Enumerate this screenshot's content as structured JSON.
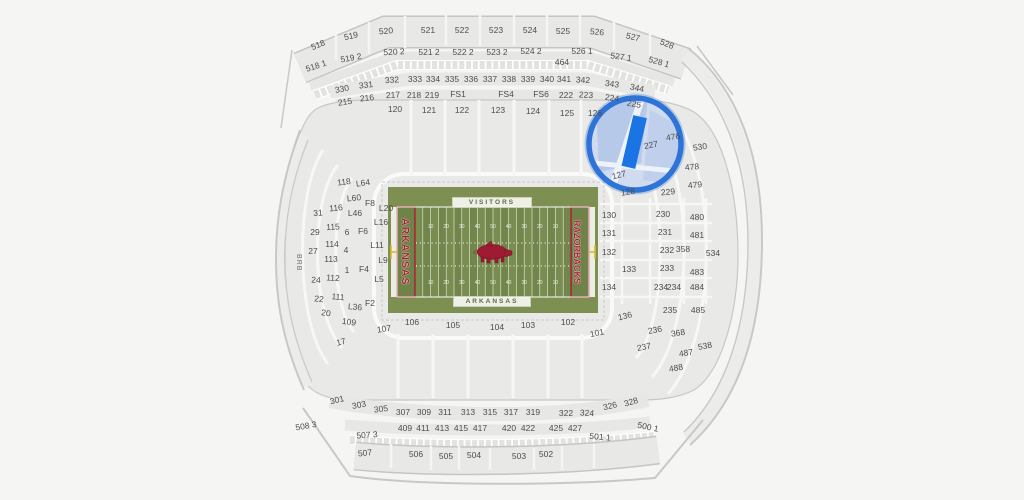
{
  "map": {
    "background": "#f5f5f3",
    "section_fill": "#e8e8e6",
    "section_stroke": "#c6c6c4",
    "label_color": "#4d4d4d",
    "left_wall_label": "BRB",
    "highlight": {
      "section": "227",
      "ring_color": "#2d73d8",
      "area_fill": "#cdd9ef",
      "selected_fill": "#1b74e4",
      "cx": 635,
      "cy": 144,
      "radius": 46
    },
    "field": {
      "visitors_label": "VISITORS",
      "home_label": "ARKANSAS",
      "left_endzone_text": "ARKANSAS",
      "right_endzone_text": "RAZORBACKS",
      "yard_numbers": [
        "10",
        "20",
        "30",
        "40",
        "50",
        "40",
        "30",
        "20",
        "10"
      ],
      "grass_base": "#7d9052",
      "stripe_light": "#7a8d50",
      "stripe_dark": "#72854a",
      "endzone_fill": "#6f8247",
      "endzone_red": "#a81e35",
      "logo_red": "#9e1b32",
      "goalpost_yellow": "#d9b92c"
    },
    "sections": [
      {
        "t": "518",
        "x": 318,
        "y": 45,
        "r": -22
      },
      {
        "t": "519",
        "x": 351,
        "y": 36,
        "r": -13
      },
      {
        "t": "520",
        "x": 386,
        "y": 31,
        "r": -5
      },
      {
        "t": "521",
        "x": 428,
        "y": 30,
        "r": 0
      },
      {
        "t": "522",
        "x": 462,
        "y": 30,
        "r": 0
      },
      {
        "t": "523",
        "x": 496,
        "y": 30,
        "r": 0
      },
      {
        "t": "524",
        "x": 530,
        "y": 30,
        "r": 0
      },
      {
        "t": "525",
        "x": 563,
        "y": 31,
        "r": 0
      },
      {
        "t": "526",
        "x": 597,
        "y": 32,
        "r": 5
      },
      {
        "t": "527",
        "x": 633,
        "y": 37,
        "r": 13
      },
      {
        "t": "528",
        "x": 667,
        "y": 44,
        "r": 22
      },
      {
        "t": "518 1",
        "x": 316,
        "y": 66,
        "r": -18
      },
      {
        "t": "519 2",
        "x": 351,
        "y": 58,
        "r": -10
      },
      {
        "t": "520 2",
        "x": 394,
        "y": 52,
        "r": -3
      },
      {
        "t": "521 2",
        "x": 429,
        "y": 52,
        "r": 0
      },
      {
        "t": "522 2",
        "x": 463,
        "y": 52,
        "r": 0
      },
      {
        "t": "523 2",
        "x": 497,
        "y": 52,
        "r": 0
      },
      {
        "t": "524 2",
        "x": 531,
        "y": 51,
        "r": 0
      },
      {
        "t": "526 1",
        "x": 582,
        "y": 51,
        "r": 0
      },
      {
        "t": "527 1",
        "x": 621,
        "y": 57,
        "r": 8
      },
      {
        "t": "528 1",
        "x": 659,
        "y": 62,
        "r": 16
      },
      {
        "t": "464",
        "x": 562,
        "y": 62,
        "r": 0
      },
      {
        "t": "330",
        "x": 342,
        "y": 89,
        "r": -10
      },
      {
        "t": "331",
        "x": 366,
        "y": 85,
        "r": -7
      },
      {
        "t": "332",
        "x": 392,
        "y": 80,
        "r": -4
      },
      {
        "t": "333",
        "x": 415,
        "y": 79,
        "r": 0
      },
      {
        "t": "334",
        "x": 433,
        "y": 79,
        "r": 0
      },
      {
        "t": "335",
        "x": 452,
        "y": 79,
        "r": 0
      },
      {
        "t": "336",
        "x": 471,
        "y": 79,
        "r": 0
      },
      {
        "t": "337",
        "x": 490,
        "y": 79,
        "r": 0
      },
      {
        "t": "338",
        "x": 509,
        "y": 79,
        "r": 0
      },
      {
        "t": "339",
        "x": 528,
        "y": 79,
        "r": 0
      },
      {
        "t": "340",
        "x": 547,
        "y": 79,
        "r": 0
      },
      {
        "t": "341",
        "x": 564,
        "y": 79,
        "r": 0
      },
      {
        "t": "342",
        "x": 583,
        "y": 80,
        "r": 3
      },
      {
        "t": "343",
        "x": 612,
        "y": 84,
        "r": 8
      },
      {
        "t": "344",
        "x": 637,
        "y": 88,
        "r": 12
      },
      {
        "t": "215",
        "x": 345,
        "y": 102,
        "r": -8
      },
      {
        "t": "216",
        "x": 367,
        "y": 98,
        "r": -6
      },
      {
        "t": "217",
        "x": 393,
        "y": 95,
        "r": -3
      },
      {
        "t": "218",
        "x": 414,
        "y": 95,
        "r": 0
      },
      {
        "t": "219",
        "x": 432,
        "y": 95,
        "r": 0
      },
      {
        "t": "FS1",
        "x": 458,
        "y": 94,
        "r": 0
      },
      {
        "t": "FS4",
        "x": 506,
        "y": 94,
        "r": 0
      },
      {
        "t": "FS6",
        "x": 541,
        "y": 94,
        "r": 0
      },
      {
        "t": "222",
        "x": 566,
        "y": 95,
        "r": 0
      },
      {
        "t": "223",
        "x": 586,
        "y": 95,
        "r": 3
      },
      {
        "t": "224",
        "x": 612,
        "y": 98,
        "r": 8
      },
      {
        "t": "225",
        "x": 634,
        "y": 104,
        "r": 10
      },
      {
        "t": "120",
        "x": 395,
        "y": 109,
        "r": 0
      },
      {
        "t": "121",
        "x": 429,
        "y": 110,
        "r": 0
      },
      {
        "t": "122",
        "x": 462,
        "y": 110,
        "r": 0
      },
      {
        "t": "123",
        "x": 498,
        "y": 110,
        "r": 0
      },
      {
        "t": "124",
        "x": 533,
        "y": 111,
        "r": 0
      },
      {
        "t": "125",
        "x": 567,
        "y": 113,
        "r": 0
      },
      {
        "t": "126",
        "x": 595,
        "y": 113,
        "r": 0
      },
      {
        "t": "118",
        "x": 344,
        "y": 182,
        "r": -8
      },
      {
        "t": "116",
        "x": 336,
        "y": 208,
        "r": -5
      },
      {
        "t": "115",
        "x": 333,
        "y": 227,
        "r": -3
      },
      {
        "t": "114",
        "x": 332,
        "y": 244,
        "r": 0
      },
      {
        "t": "113",
        "x": 331,
        "y": 259,
        "r": 0
      },
      {
        "t": "112",
        "x": 333,
        "y": 278,
        "r": 3
      },
      {
        "t": "111",
        "x": 338,
        "y": 297,
        "r": 5
      },
      {
        "t": "109",
        "x": 349,
        "y": 322,
        "r": 8
      },
      {
        "t": "L64",
        "x": 363,
        "y": 183,
        "r": -8
      },
      {
        "t": "L60",
        "x": 354,
        "y": 198,
        "r": -5
      },
      {
        "t": "F8",
        "x": 370,
        "y": 203,
        "r": 0
      },
      {
        "t": "L20",
        "x": 386,
        "y": 208,
        "r": 0
      },
      {
        "t": "L46",
        "x": 355,
        "y": 213,
        "r": 0
      },
      {
        "t": "L16",
        "x": 381,
        "y": 222,
        "r": 0
      },
      {
        "t": "6",
        "x": 347,
        "y": 232,
        "r": 0
      },
      {
        "t": "F6",
        "x": 363,
        "y": 231,
        "r": 0
      },
      {
        "t": "L11",
        "x": 377,
        "y": 245,
        "r": 0
      },
      {
        "t": "4",
        "x": 346,
        "y": 250,
        "r": 0
      },
      {
        "t": "L9",
        "x": 383,
        "y": 260,
        "r": 0
      },
      {
        "t": "1",
        "x": 347,
        "y": 270,
        "r": 0
      },
      {
        "t": "F4",
        "x": 364,
        "y": 269,
        "r": 0
      },
      {
        "t": "L5",
        "x": 379,
        "y": 279,
        "r": 0
      },
      {
        "t": "L36",
        "x": 355,
        "y": 307,
        "r": 5
      },
      {
        "t": "F2",
        "x": 370,
        "y": 303,
        "r": 0
      },
      {
        "t": "31",
        "x": 318,
        "y": 213,
        "r": -3
      },
      {
        "t": "29",
        "x": 315,
        "y": 232,
        "r": 0
      },
      {
        "t": "27",
        "x": 313,
        "y": 251,
        "r": 0
      },
      {
        "t": "24",
        "x": 316,
        "y": 280,
        "r": 3
      },
      {
        "t": "22",
        "x": 319,
        "y": 299,
        "r": 6
      },
      {
        "t": "20",
        "x": 326,
        "y": 313,
        "r": 8
      },
      {
        "t": "17",
        "x": 341,
        "y": 342,
        "r": -15
      },
      {
        "t": "107",
        "x": 384,
        "y": 329,
        "r": -8
      },
      {
        "t": "106",
        "x": 412,
        "y": 322,
        "r": 0
      },
      {
        "t": "105",
        "x": 453,
        "y": 325,
        "r": 0
      },
      {
        "t": "104",
        "x": 497,
        "y": 327,
        "r": 0
      },
      {
        "t": "103",
        "x": 528,
        "y": 325,
        "r": 0
      },
      {
        "t": "102",
        "x": 568,
        "y": 322,
        "r": 0
      },
      {
        "t": "101",
        "x": 597,
        "y": 333,
        "r": -12
      },
      {
        "t": "127",
        "x": 619,
        "y": 175,
        "r": -14
      },
      {
        "t": "128",
        "x": 628,
        "y": 192,
        "r": -8
      },
      {
        "t": "136",
        "x": 625,
        "y": 316,
        "r": -14
      },
      {
        "t": "130",
        "x": 609,
        "y": 215,
        "r": 0
      },
      {
        "t": "131",
        "x": 609,
        "y": 233,
        "r": 0
      },
      {
        "t": "132",
        "x": 609,
        "y": 252,
        "r": 0
      },
      {
        "t": "133",
        "x": 629,
        "y": 269,
        "r": 0
      },
      {
        "t": "134",
        "x": 609,
        "y": 287,
        "r": 0
      },
      {
        "t": "227",
        "x": 651,
        "y": 145,
        "r": -10
      },
      {
        "t": "229",
        "x": 668,
        "y": 192,
        "r": -5
      },
      {
        "t": "230",
        "x": 663,
        "y": 214,
        "r": 0
      },
      {
        "t": "231",
        "x": 665,
        "y": 232,
        "r": 0
      },
      {
        "t": "232",
        "x": 667,
        "y": 250,
        "r": 0
      },
      {
        "t": "233",
        "x": 667,
        "y": 268,
        "r": 0
      },
      {
        "t": "234",
        "x": 661,
        "y": 287,
        "r": 0
      },
      {
        "t": "234",
        "x": 674,
        "y": 287,
        "r": 0
      },
      {
        "t": "235",
        "x": 670,
        "y": 310,
        "r": 0
      },
      {
        "t": "236",
        "x": 655,
        "y": 330,
        "r": -10
      },
      {
        "t": "237",
        "x": 644,
        "y": 347,
        "r": -12
      },
      {
        "t": "476",
        "x": 673,
        "y": 137,
        "r": -8
      },
      {
        "t": "530",
        "x": 700,
        "y": 147,
        "r": -8
      },
      {
        "t": "478",
        "x": 692,
        "y": 167,
        "r": -5
      },
      {
        "t": "479",
        "x": 695,
        "y": 185,
        "r": -5
      },
      {
        "t": "480",
        "x": 697,
        "y": 217,
        "r": 0
      },
      {
        "t": "481",
        "x": 697,
        "y": 235,
        "r": 0
      },
      {
        "t": "358",
        "x": 683,
        "y": 249,
        "r": 0
      },
      {
        "t": "534",
        "x": 713,
        "y": 253,
        "r": 0
      },
      {
        "t": "483",
        "x": 697,
        "y": 272,
        "r": 0
      },
      {
        "t": "484",
        "x": 697,
        "y": 287,
        "r": 0
      },
      {
        "t": "485",
        "x": 698,
        "y": 310,
        "r": 0
      },
      {
        "t": "368",
        "x": 678,
        "y": 333,
        "r": -8
      },
      {
        "t": "538",
        "x": 705,
        "y": 346,
        "r": -10
      },
      {
        "t": "487",
        "x": 686,
        "y": 353,
        "r": -8
      },
      {
        "t": "488",
        "x": 676,
        "y": 368,
        "r": -10
      },
      {
        "t": "301",
        "x": 337,
        "y": 400,
        "r": -14
      },
      {
        "t": "303",
        "x": 359,
        "y": 405,
        "r": -11
      },
      {
        "t": "305",
        "x": 381,
        "y": 409,
        "r": -7
      },
      {
        "t": "307",
        "x": 403,
        "y": 412,
        "r": 0
      },
      {
        "t": "309",
        "x": 424,
        "y": 412,
        "r": 0
      },
      {
        "t": "311",
        "x": 445,
        "y": 412,
        "r": 0
      },
      {
        "t": "313",
        "x": 468,
        "y": 412,
        "r": 0
      },
      {
        "t": "315",
        "x": 490,
        "y": 412,
        "r": 0
      },
      {
        "t": "317",
        "x": 511,
        "y": 412,
        "r": 0
      },
      {
        "t": "319",
        "x": 533,
        "y": 412,
        "r": 0
      },
      {
        "t": "322",
        "x": 566,
        "y": 413,
        "r": 0
      },
      {
        "t": "324",
        "x": 587,
        "y": 413,
        "r": 3
      },
      {
        "t": "326",
        "x": 610,
        "y": 406,
        "r": -13
      },
      {
        "t": "328",
        "x": 631,
        "y": 402,
        "r": -16
      },
      {
        "t": "409",
        "x": 405,
        "y": 428,
        "r": 0
      },
      {
        "t": "411",
        "x": 423,
        "y": 428,
        "r": 0
      },
      {
        "t": "413",
        "x": 442,
        "y": 428,
        "r": 0
      },
      {
        "t": "415",
        "x": 461,
        "y": 428,
        "r": 0
      },
      {
        "t": "417",
        "x": 480,
        "y": 428,
        "r": 0
      },
      {
        "t": "420",
        "x": 509,
        "y": 428,
        "r": 0
      },
      {
        "t": "422",
        "x": 528,
        "y": 428,
        "r": 0
      },
      {
        "t": "425",
        "x": 556,
        "y": 428,
        "r": 0
      },
      {
        "t": "427",
        "x": 575,
        "y": 428,
        "r": 0
      },
      {
        "t": "508 3",
        "x": 306,
        "y": 426,
        "r": -10
      },
      {
        "t": "507 3",
        "x": 367,
        "y": 435,
        "r": -4
      },
      {
        "t": "501 1",
        "x": 600,
        "y": 437,
        "r": 5
      },
      {
        "t": "500 1",
        "x": 648,
        "y": 427,
        "r": 12
      },
      {
        "t": "507",
        "x": 365,
        "y": 453,
        "r": -6
      },
      {
        "t": "506",
        "x": 416,
        "y": 454,
        "r": 0
      },
      {
        "t": "505",
        "x": 446,
        "y": 456,
        "r": 0
      },
      {
        "t": "504",
        "x": 474,
        "y": 455,
        "r": 0
      },
      {
        "t": "503",
        "x": 519,
        "y": 456,
        "r": 0
      },
      {
        "t": "502",
        "x": 546,
        "y": 454,
        "r": 0
      }
    ]
  }
}
